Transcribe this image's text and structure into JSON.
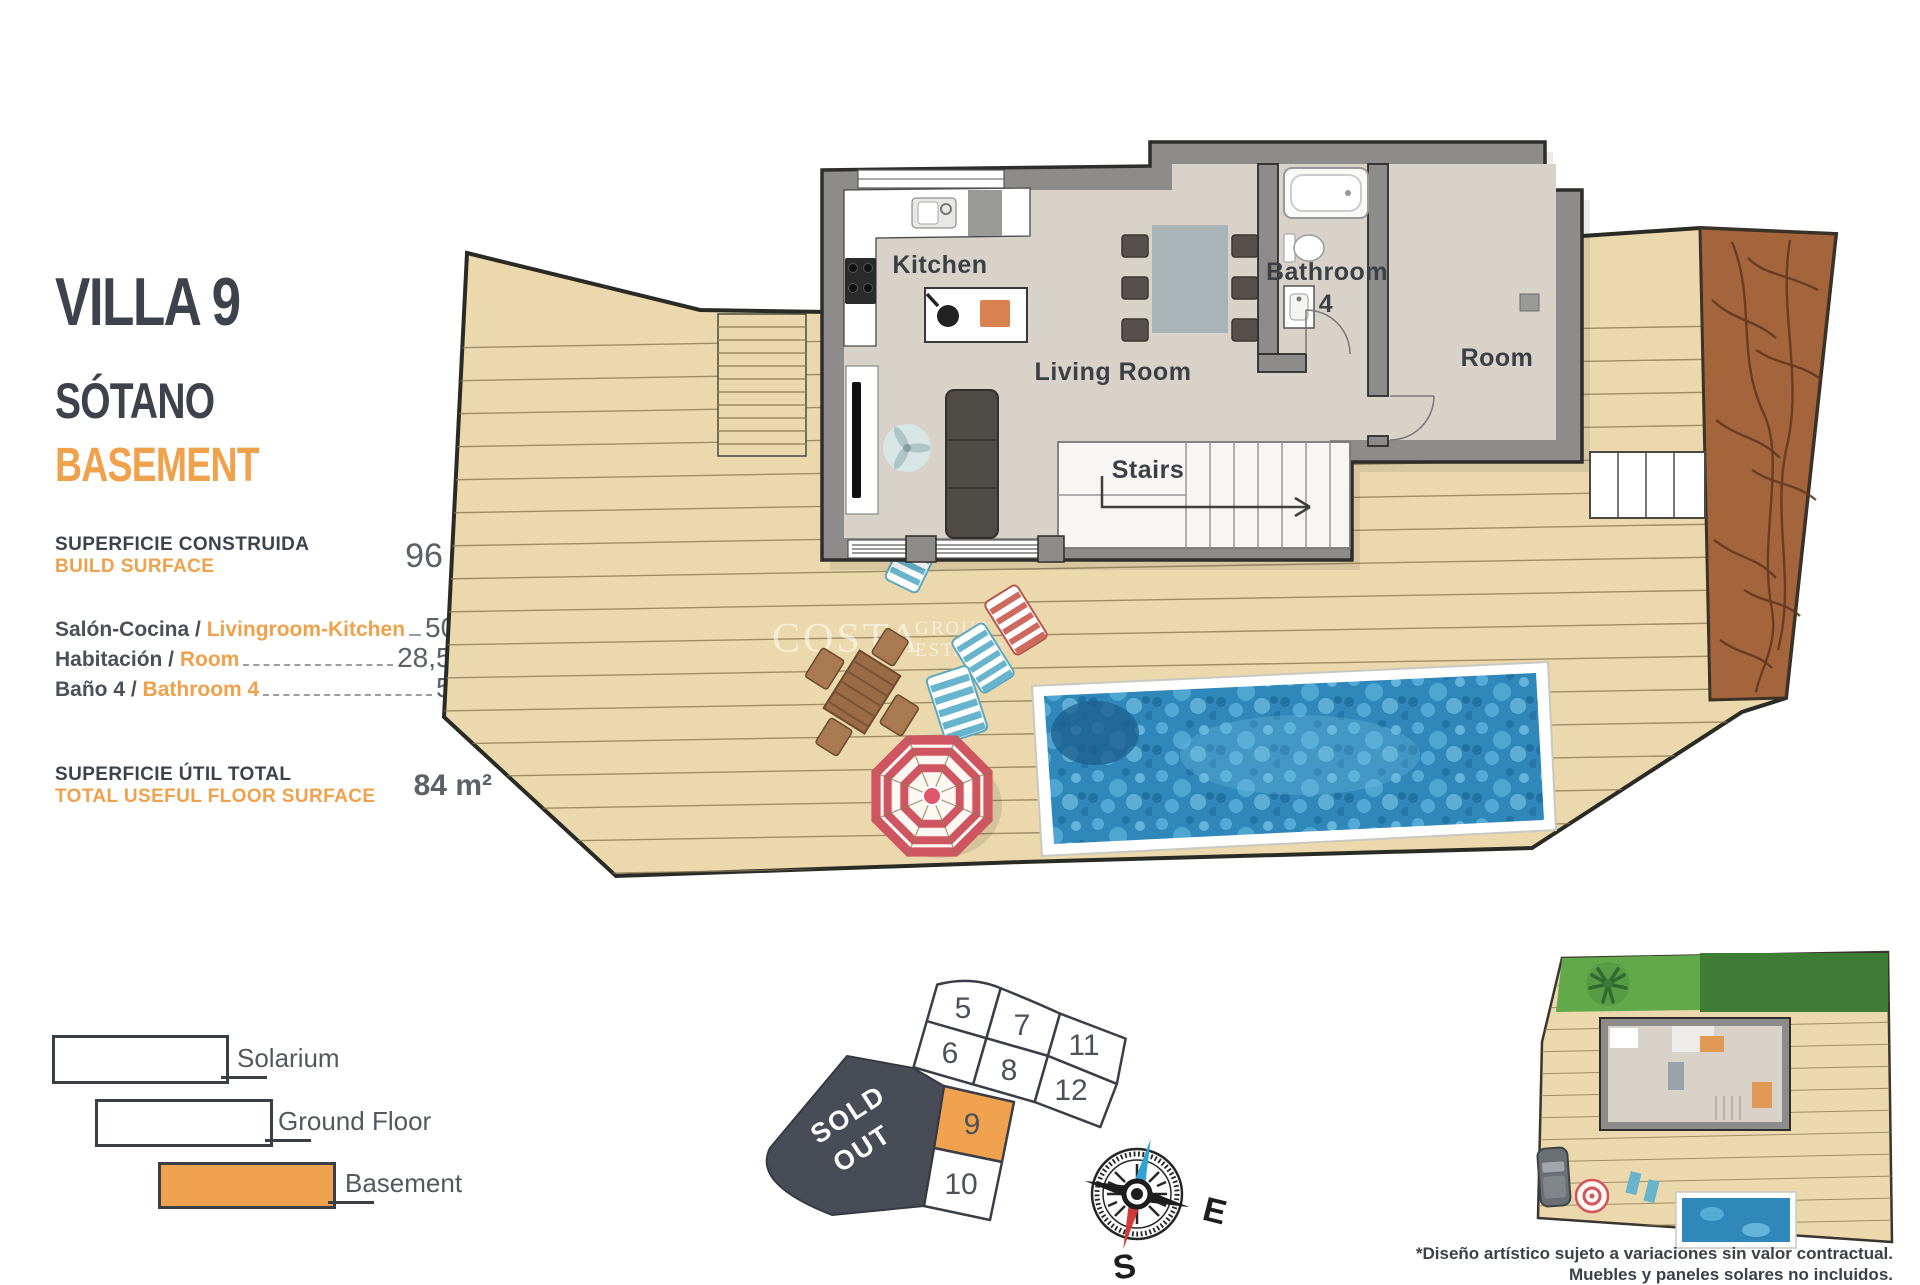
{
  "header": {
    "title": "VILLA 9",
    "subtitle_es": "SÓTANO",
    "subtitle_en": "BASEMENT"
  },
  "build_surface": {
    "label_es": "SUPERFICIE CONSTRUIDA",
    "label_en": "BUILD SURFACE",
    "value": "96 m²"
  },
  "rooms": [
    {
      "label_es": "Salón-Cocina / ",
      "label_en": "Livingroom-Kitchen",
      "value": "50,5 m²"
    },
    {
      "label_es": "Habitación / ",
      "label_en": "Room",
      "value": "28,5 m²"
    },
    {
      "label_es": "Baño 4 / ",
      "label_en": "Bathroom 4",
      "value": "5 m²"
    }
  ],
  "total": {
    "label_es": "SUPERFICIE ÚTIL TOTAL",
    "label_en": "TOTAL USEFUL FLOOR SURFACE",
    "value": "84 m²"
  },
  "floor_plan": {
    "labels": {
      "kitchen": "Kitchen",
      "living_room": "Living Room",
      "stairs": "Stairs",
      "bathroom": "Bathroom",
      "bathroom_number": "4",
      "room": "Room"
    },
    "watermark": {
      "brand": "COSTA",
      "sub1": "GROUP",
      "sub2": "ESTATES"
    }
  },
  "legend": {
    "items": [
      {
        "label": "Solarium"
      },
      {
        "label": "Ground Floor"
      },
      {
        "label": "Basement"
      }
    ]
  },
  "site_map": {
    "parcels": [
      "5",
      "7",
      "11",
      "6",
      "8",
      "12",
      "9",
      "10"
    ],
    "highlighted_parcel": "9",
    "sold_line1": "SOLD",
    "sold_line2": "OUT"
  },
  "compass": {
    "east": "E",
    "south": "S"
  },
  "disclaimer": {
    "line1": "*Diseño artístico sujeto a variaciones sin valor contractual.",
    "line2": "Muebles y paneles solares no incluidos."
  },
  "colors": {
    "accent_orange": "#f0a14c",
    "title_dark": "#3d434d",
    "value_gray": "#5c6067",
    "deck_tan": "#ebd8ac",
    "wall_gray": "#8d8c8a",
    "pool_blue": "#2f87ba",
    "dirt_brown": "#a5653c",
    "sold_out_dark": "#474c56"
  }
}
